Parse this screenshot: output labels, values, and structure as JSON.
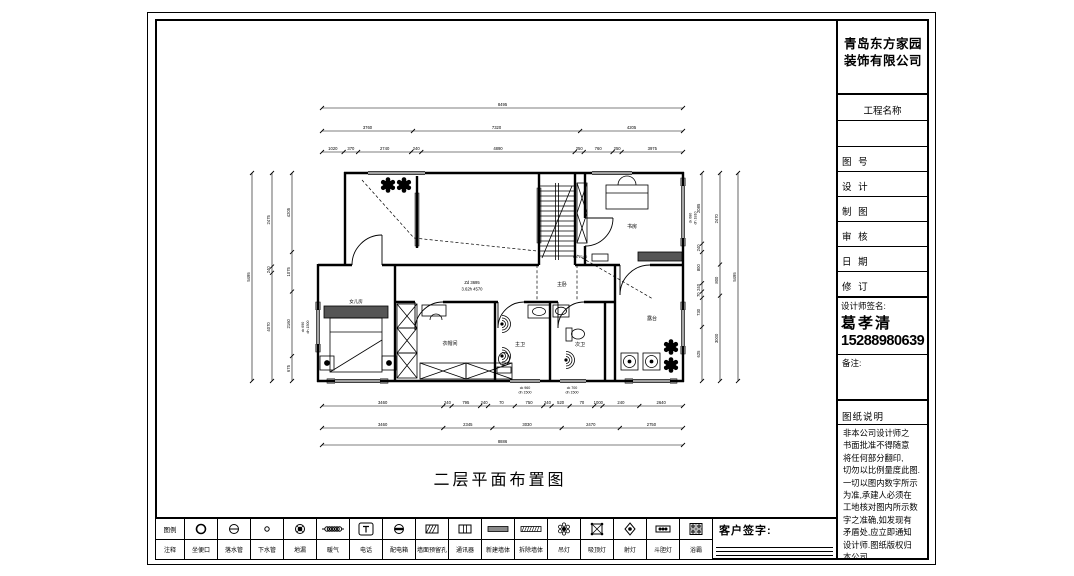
{
  "title_block": {
    "company_line1": "青岛东方家园",
    "company_line2": "装饰有限公司",
    "project_label": "工程名称",
    "rows": [
      "图 号",
      "设 计",
      "制 图",
      "审 核",
      "日 期",
      "修 订"
    ],
    "designer_label": "设计师签名:",
    "designer_name": "葛孝清",
    "designer_phone": "15288980639",
    "remarks_label": "备注:",
    "notes_title": "图纸说明",
    "notes_body": "非本公司设计师之\n书面批准不得随意\n将任何部分翻印,\n切勿以比例量度此图.\n一切以图内数字所示\n为准,承建人必须在\n工地核对图内所示数\n字之准确,如发现有\n矛盾处,应立即通知\n设计师.图纸版权归\n本公司."
  },
  "drawing": {
    "title": "二层平面布置图",
    "rooms": {
      "daughter": "女儿房",
      "cloak": "衣帽间",
      "master_bath": "主卫",
      "second_bath": "次卫",
      "master_bed": "主卧",
      "study": "书房",
      "terrace": "露台"
    },
    "ann": {
      "zd": "Zd 3695",
      "height": "3.62h 4570",
      "mk": "mk 2140"
    },
    "win": {
      "w1a": "ck 960",
      "w1b": "dh 1500",
      "w2a": "ck 700",
      "w2b": "dh 1500",
      "w3a": "ck 680",
      "w3b": "dh 1810",
      "w4a": "ck 690",
      "w4b": "dh 1500"
    }
  },
  "plan_dims": [
    {
      "o": "h",
      "p": 20,
      "a": 82,
      "b": 443,
      "t": [
        0,
        1
      ],
      "l": [
        "8495"
      ]
    },
    {
      "o": "h",
      "p": 43,
      "a": 82,
      "b": 443,
      "t": [
        0,
        0.252,
        0.715,
        1
      ],
      "l": [
        "3760",
        "7320",
        "4205"
      ]
    },
    {
      "o": "h",
      "p": 64,
      "a": 82,
      "b": 443,
      "t": [
        0,
        0.06,
        0.1,
        0.247,
        0.275,
        0.7,
        0.725,
        0.805,
        0.83,
        1
      ],
      "l": [
        "1020",
        "370",
        "2740",
        "240",
        "4890",
        "250",
        "760",
        "250",
        "3975"
      ]
    },
    {
      "o": "h",
      "p": 318,
      "a": 82,
      "b": 443,
      "t": [
        0,
        0.336,
        0.359,
        0.438,
        0.46,
        0.534,
        0.613,
        0.636,
        0.686,
        0.754,
        0.777,
        0.879,
        1
      ],
      "l": [
        "3460",
        "240",
        "795",
        "240",
        "70",
        "750",
        "240",
        "520",
        "70",
        "1000",
        "240",
        "2640"
      ]
    },
    {
      "o": "h",
      "p": 340,
      "a": 82,
      "b": 443,
      "t": [
        0,
        0.336,
        0.472,
        0.664,
        0.825,
        1
      ],
      "l": [
        "3460",
        "2345",
        "3030",
        "2470",
        "2750"
      ]
    },
    {
      "o": "h",
      "p": 357,
      "a": 82,
      "b": 443,
      "t": [
        0,
        1
      ],
      "l": [
        "8886"
      ]
    },
    {
      "o": "v",
      "p": 12,
      "a": 85,
      "b": 293,
      "t": [
        0,
        1
      ],
      "l": [
        "5495"
      ]
    },
    {
      "o": "v",
      "p": 32,
      "a": 85,
      "b": 293,
      "t": [
        0,
        0.45,
        0.48,
        1
      ],
      "l": [
        "2475",
        "240",
        "4070"
      ]
    },
    {
      "o": "v",
      "p": 52,
      "a": 85,
      "b": 293,
      "t": [
        0,
        0.38,
        0.57,
        0.88,
        1
      ],
      "l": [
        "4205",
        "1075",
        "2160",
        "675"
      ]
    },
    {
      "o": "v",
      "p": 462,
      "a": 85,
      "b": 293,
      "t": [
        0,
        0.34,
        0.38,
        0.53,
        0.57,
        0.6,
        0.74,
        1
      ],
      "l": [
        "2085",
        "240",
        "800",
        "240",
        "70",
        "730",
        "625"
      ]
    },
    {
      "o": "v",
      "p": 480,
      "a": 85,
      "b": 293,
      "t": [
        0,
        0.44,
        0.59,
        1
      ],
      "l": [
        "2470",
        "800",
        "3000"
      ]
    },
    {
      "o": "v",
      "p": 498,
      "a": 85,
      "b": 293,
      "t": [
        0,
        1
      ],
      "l": [
        "5495"
      ]
    }
  ],
  "legend": {
    "header_top": "图例",
    "header_bottom": "注释",
    "sign_label": "客户签字:",
    "items": [
      {
        "icon": "toilet-outlet",
        "label": "坐便口"
      },
      {
        "icon": "downpipe",
        "label": "落水管"
      },
      {
        "icon": "drainpipe",
        "label": "下水管"
      },
      {
        "icon": "floor-drain",
        "label": "地漏"
      },
      {
        "icon": "heating",
        "label": "暖气"
      },
      {
        "icon": "telephone",
        "label": "电话"
      },
      {
        "icon": "distribution-box",
        "label": "配电箱"
      },
      {
        "icon": "wall-hole",
        "label": "墙面预留孔"
      },
      {
        "icon": "communicator",
        "label": "通讯器"
      },
      {
        "icon": "new-wall",
        "label": "新建墙体"
      },
      {
        "icon": "demolish-wall",
        "label": "拆除墙体"
      },
      {
        "icon": "pendant-lamp",
        "label": "吊灯"
      },
      {
        "icon": "ceiling-lamp",
        "label": "吸顶灯"
      },
      {
        "icon": "spotlight",
        "label": "射灯"
      },
      {
        "icon": "recessed-lamp",
        "label": "斗胆灯"
      },
      {
        "icon": "bath-heater",
        "label": "浴霸"
      }
    ]
  }
}
